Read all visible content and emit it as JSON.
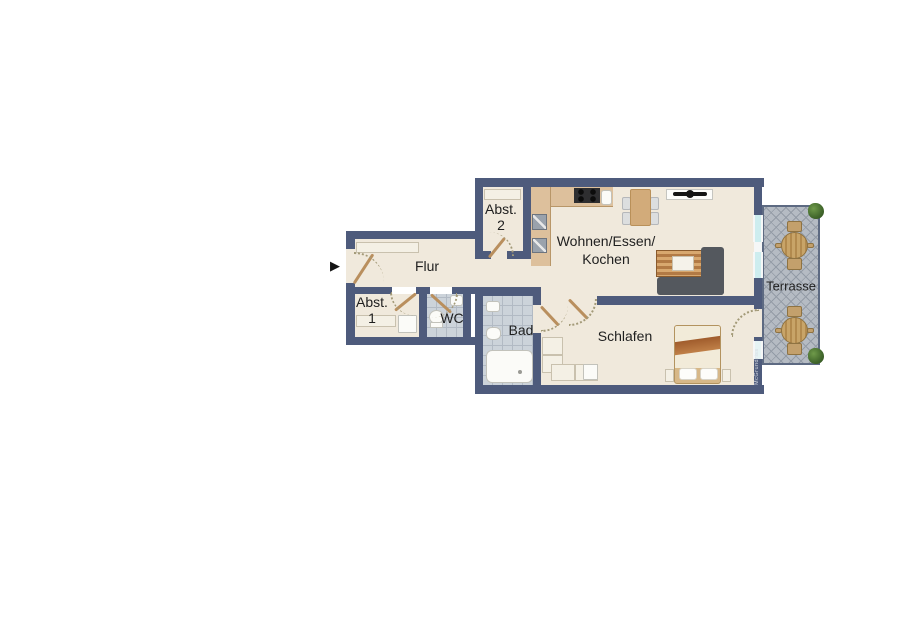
{
  "rooms": {
    "flur": {
      "label": "Flur"
    },
    "abstellraum_1": {
      "line1": "Abst.",
      "line2": "1"
    },
    "abstellraum_2": {
      "line1": "Abst.",
      "line2": "2"
    },
    "wc": {
      "label": "WC"
    },
    "bad": {
      "label": "Bad"
    },
    "wohnen_essen_kochen": {
      "line1": "Wohnen/Essen/",
      "line2": "Kochen"
    },
    "schlafen": {
      "label": "Schlafen"
    },
    "terrasse": {
      "label": "Terrasse"
    }
  },
  "watermark": {
    "text": "McGrundriss"
  },
  "icons": {
    "entrance_arrow": "▶"
  },
  "colors": {
    "wall": "#4e5b7c",
    "floor": "#f0e9dc",
    "tile_floor": "#ccd3da",
    "tile_grid": "#b2bac4",
    "terrace_floor": "#b5bbc3",
    "terrace_lattice": "#939ba6",
    "terrace_border": "#5d6a82",
    "door_leaf": "#b98f5e",
    "swing": "#a39a78",
    "window_glass": "#cdedef",
    "window_frame": "#f5f7f7",
    "kitchen_counter": "#ddc09c",
    "kitchen_edge": "#b89668",
    "wood_dark": "#b27a45",
    "wood_light": "#d8a86f",
    "sofa": "#54585e",
    "bed_base": "#d7b888",
    "bed_duvet": "#f2ebd9",
    "bed_blanket": "#a05c2c",
    "furn_light": "#f4f0e5",
    "furn_border": "#c9c1ae",
    "fixture_white": "#fbfbf8",
    "fixture_border": "#c2c2bb",
    "plant": "#42682c",
    "label_text": "#1f1f1f",
    "chair_gray": "#dcdedf",
    "table_wood": "#d2ab7a",
    "appliance_gray": "#9aa2ac",
    "stove_dark": "#2e2e30"
  }
}
